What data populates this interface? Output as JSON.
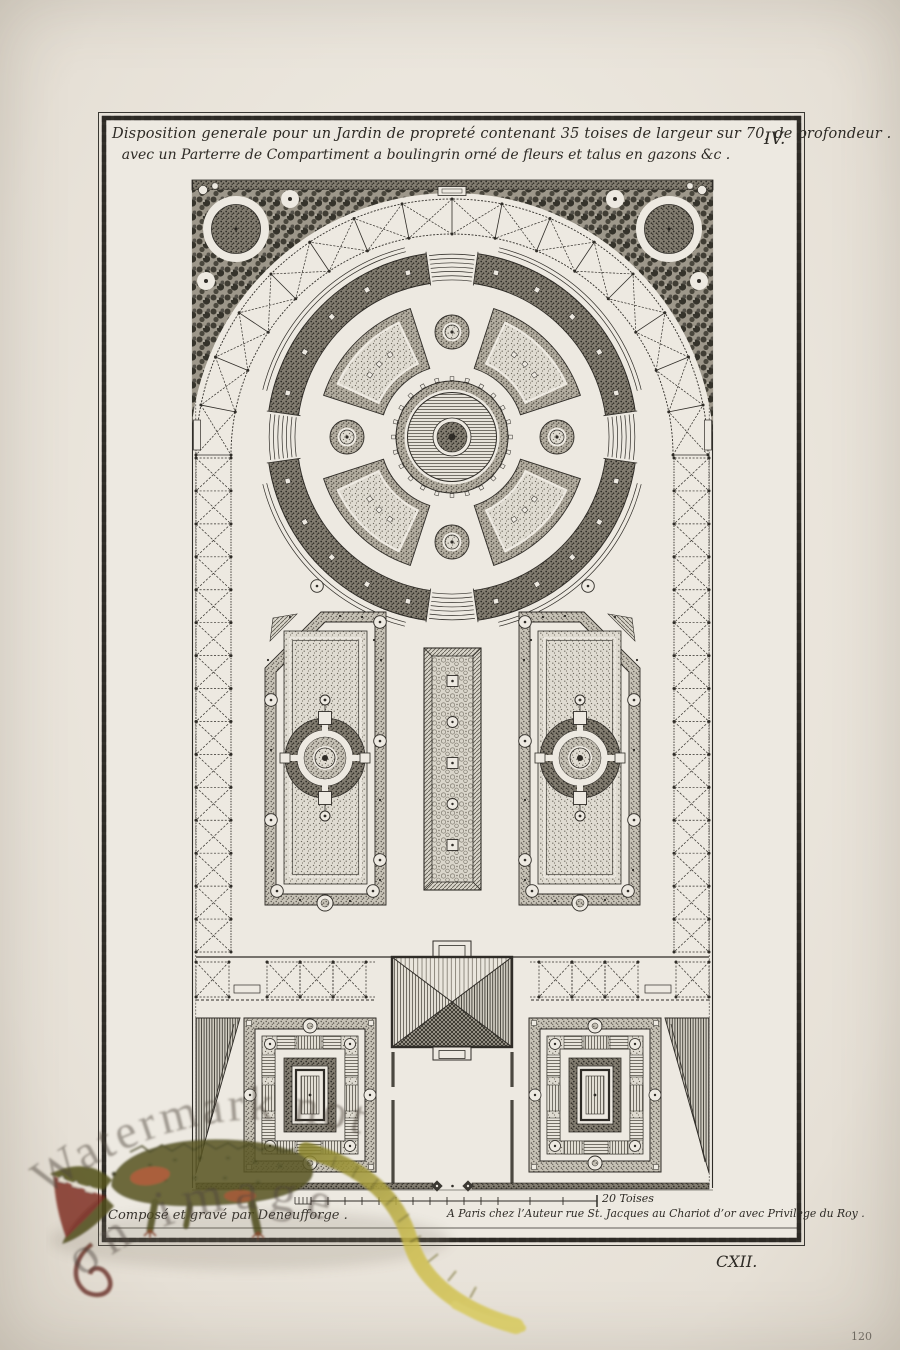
{
  "plate": {
    "title_line1": "Disposition generale pour un Jardin de propreté contenant 35 toises de largeur sur 70, de profondeur .",
    "title_line2": "avec un Parterre de Compartiment a boulingrin orné de fleurs et talus en gazons &c .",
    "plate_number": "IV.",
    "plate_roman": "CXII."
  },
  "imprint": {
    "credit_left": "Composé et gravé par Deneufforge .",
    "publisher_right": "A Paris chez l’Auteur rue St. Jacques au Chariot d’or avec Privilege du Roy ."
  },
  "scale_bar": {
    "label": "20 Toises"
  },
  "page_number": "120",
  "watermark": {
    "arc_line1": "Watermark not",
    "arc_line2": "on image"
  },
  "colors": {
    "paper": "#ede9e1",
    "page_margin": "#e8e3da",
    "ink": "#2f2c27",
    "plate_border": "#34312b",
    "watermark_text": "#4b443a",
    "crocodile_body": "#5c5926",
    "crocodile_tail": "#cdbd4f",
    "crocodile_accent": "#ad4b27",
    "mouth_red": "#78231a"
  }
}
